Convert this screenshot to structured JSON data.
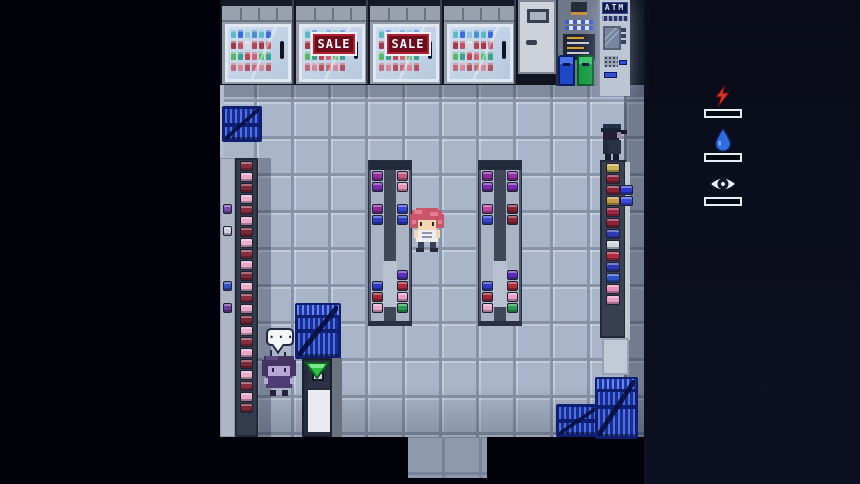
{
  "scene": {
    "name": "convenience-store-interior",
    "background_left": "#010109",
    "background_right": "#0b0e1c",
    "floor_color": "#a9b5c8"
  },
  "hud": {
    "stats": [
      {
        "id": "energy",
        "icon": "lightning-bolt-icon",
        "color": "#d8302a",
        "meter": "empty"
      },
      {
        "id": "hydration",
        "icon": "water-droplet-icon",
        "color": "#2f6ce0",
        "meter": "empty"
      },
      {
        "id": "perception",
        "icon": "eye-icon",
        "color": "#edf0f6",
        "meter": "empty"
      }
    ]
  },
  "store": {
    "sale_sign": {
      "label": "SALE",
      "bg": "#6b0d1d",
      "text_color": "#f2f4f8"
    },
    "atm": {
      "label": "ATM",
      "sign_bg": "#101a44",
      "label_color": "#dce4ff"
    },
    "speech_bubble": {
      "text": "..."
    },
    "quest_marker": {
      "shape": "arrow-down",
      "color": "#2cc242"
    },
    "basket_color": "#152d94",
    "fridge_rows": [
      [
        "#59b9c9",
        "#3a6ae0",
        "#8cc3da",
        "#4a90d0",
        "#59b9c9",
        "#3a6ae0"
      ],
      [
        "#a23a4a",
        "#c25262",
        "#d8dae2",
        "#b24252",
        "#a23a4a",
        "#c25262"
      ],
      [
        "#58b868",
        "#3aa090",
        "#c24252",
        "#d26272",
        "#58b868",
        "#3aa090"
      ],
      [
        "#c26a7a",
        "#d28a9a",
        "#b25262",
        "#c26a7a",
        "#d28a9a",
        "#b25262"
      ]
    ],
    "shelves": {
      "left_wall_sparse": {
        "items": [
          null,
          null,
          null,
          null,
          "#7a4ab0",
          null,
          "#ccd0da",
          null,
          null,
          null,
          null,
          "#3050c0",
          null,
          "#6a3a9a",
          null,
          null,
          null,
          null,
          null,
          null,
          null,
          null
        ]
      },
      "left_wall_dense": {
        "items": [
          "#8a2e3e",
          "#e8a8c6",
          "#7a2838",
          "#eab0cc",
          "#8a2e3e",
          "#e8a8c6",
          "#7a2838",
          "#eab0cc",
          "#8a2e3e",
          "#e8a8c6",
          "#7a2838",
          "#eab0cc",
          "#8a2e3e",
          "#e8a8c6",
          "#7a2838",
          "#eab0cc",
          "#8a2e3e",
          "#e8a8c6",
          "#7a2838",
          "#eab0cc",
          "#8a2e3e",
          "#e8a8c6",
          "#7a2838"
        ]
      },
      "aisle_a_left": {
        "items": [
          "#922e9e",
          "#7a2ab0",
          null,
          "#8a2a9a",
          "#2e3cc4",
          null,
          null,
          null,
          null,
          null,
          "#3038c4",
          "#a02636",
          "#eba6ca"
        ]
      },
      "aisle_a_right": {
        "items": [
          "#c65a7e",
          "#e892b4",
          null,
          "#3646d2",
          "#2e3cc4",
          null,
          null,
          null,
          null,
          "#5c2cba",
          "#b02a3a",
          "#ea9ec6",
          "#2a9a50"
        ]
      },
      "aisle_b_left": {
        "items": [
          "#8a2a9a",
          "#7a2ab0",
          null,
          "#c444a4",
          "#3646d2",
          null,
          null,
          null,
          null,
          null,
          "#3038c4",
          "#a02636",
          "#eba6ca"
        ]
      },
      "aisle_b_right": {
        "items": [
          "#922e9e",
          "#7a2ab0",
          null,
          "#8a2434",
          "#8a2434",
          null,
          null,
          null,
          null,
          "#5c2cba",
          "#b02a3a",
          "#ea9ec6",
          "#2a9a50"
        ]
      },
      "right_wall": {
        "items": [
          "#c9b257",
          "#8a2338",
          "#8a2338",
          "#c39a4a",
          "#9c2742",
          "#8a2338",
          "#2e3ab2",
          "#d2d6de",
          "#b22c42",
          "#2e3ab2",
          "#2e52c2",
          "#e592ba",
          "#e8a0c8",
          null
        ]
      },
      "right_side_cluster": {
        "items": [
          "#2e3ad0",
          "#3a4ae0"
        ]
      }
    }
  },
  "sprites": [
    {
      "id": "player",
      "label": "pink-haired-shopper"
    },
    {
      "id": "npc-purple",
      "label": "purple-haired-npc"
    },
    {
      "id": "npc-customer",
      "label": "capped-npc"
    }
  ]
}
